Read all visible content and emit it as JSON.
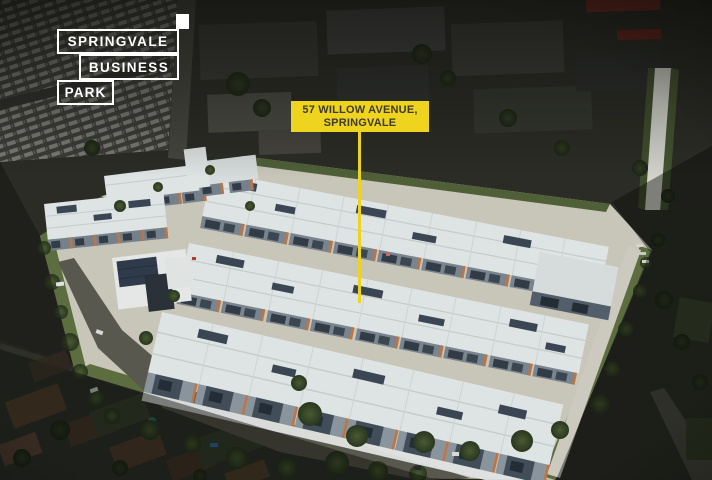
{
  "scene": {
    "alt": "Oblique aerial photograph of a business park estate: rows of white-roofed warehouse units with solar panels and orange facade accents, bright concrete driveways, perimeter trees and roads, surrounded by a darkened industrial area above and residential houses below"
  },
  "brand": {
    "name": "Springvale Business Park",
    "lines": [
      "SPRINGVALE",
      "BUSINESS",
      "PARK"
    ]
  },
  "callout": {
    "line1": "57 WILLOW AVENUE,",
    "line2": "SPRINGVALE"
  },
  "palette": {
    "yellow": "#EFD41F",
    "white": "#FFFFFF",
    "callout_text": "#3C3A32",
    "concrete": "#C8C5B9",
    "roof": "#DEE3E3",
    "facade": "#6E7983",
    "orange": "#C1743F",
    "solar": "#3A4654",
    "asphalt": "#59584F",
    "grass": "#5C6D3F",
    "tree": "#36432A",
    "ground_dark": "#2B2C26"
  }
}
